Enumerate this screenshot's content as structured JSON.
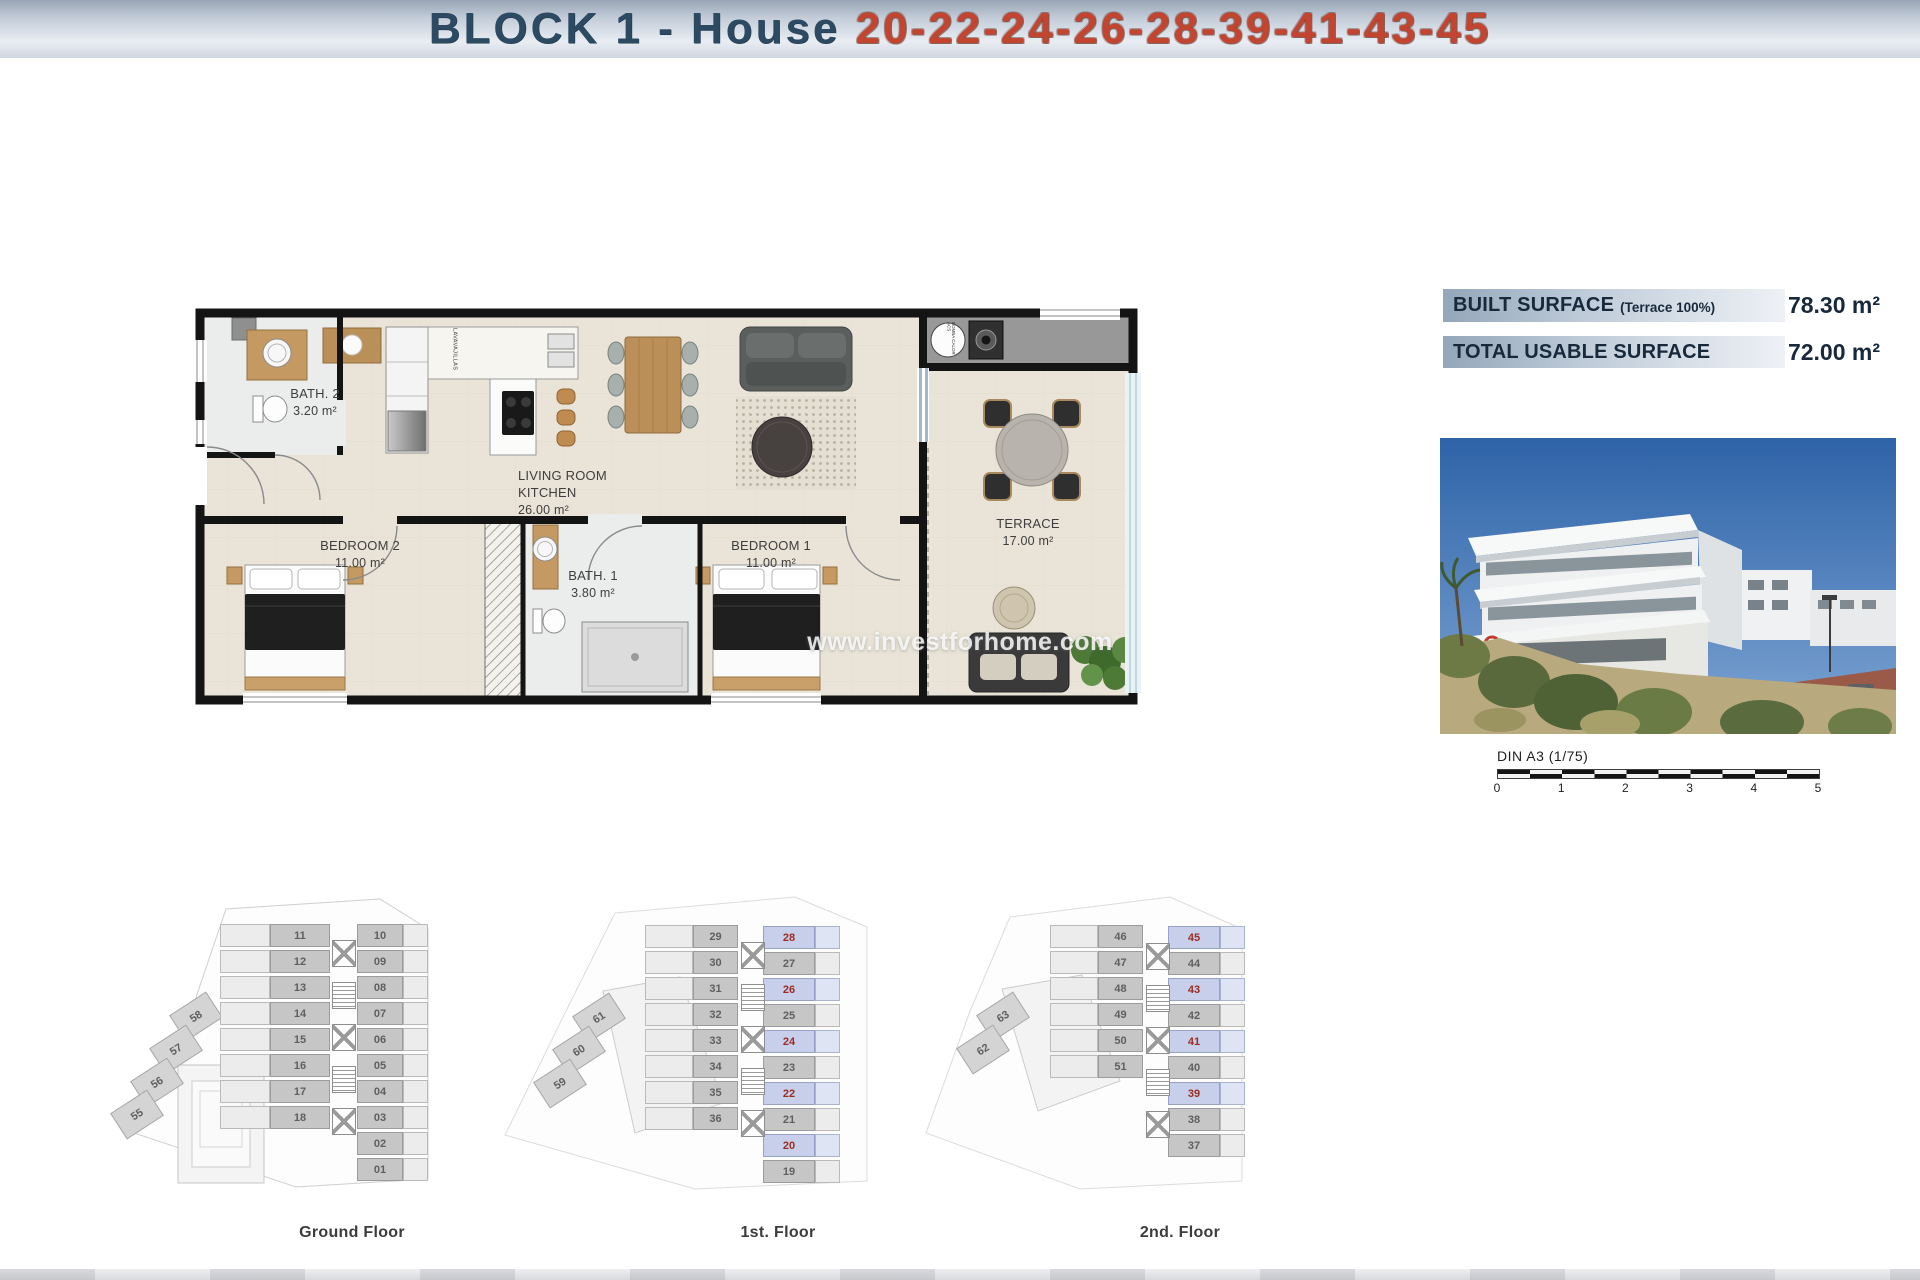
{
  "header": {
    "title_prefix": "BLOCK 1 - House ",
    "title_numbers": "20-22-24-26-28-39-41-43-45",
    "prefix_color": "#2d4a63",
    "numbers_color": "#c4452f"
  },
  "surface_panel": {
    "rows": [
      {
        "label": "BUILT SURFACE",
        "sublabel": "(Terrace 100%)",
        "value": "78.30 m²"
      },
      {
        "label": "TOTAL USABLE SURFACE",
        "sublabel": "",
        "value": "72.00 m²"
      }
    ]
  },
  "floorplan": {
    "rooms": {
      "bath2": {
        "name": "BATH. 2",
        "area": "3.20 m²"
      },
      "living": {
        "name": "LIVING ROOM KITCHEN",
        "area": "26.00 m²"
      },
      "bedroom2": {
        "name": "BEDROOM 2",
        "area": "11.00 m²"
      },
      "bath1": {
        "name": "BATH. 1",
        "area": "3.80 m²"
      },
      "bedroom1": {
        "name": "BEDROOM 1",
        "area": "11.00 m²"
      },
      "terrace": {
        "name": "TERRACE",
        "area": "17.00 m²"
      }
    },
    "annotations": {
      "dishwasher": "LAVAVAJILLAS",
      "heat_pump": "BOMBA CALOR ACS"
    }
  },
  "watermark": "www.investforhome.com",
  "scale_bar": {
    "label": "DIN A3 (1/75)",
    "ticks": [
      "0",
      "1",
      "2",
      "3",
      "4",
      "5"
    ]
  },
  "floors": [
    {
      "label": "Ground Floor",
      "left_units": [
        "11",
        "12",
        "13",
        "14",
        "15",
        "16",
        "17",
        "18"
      ],
      "right_units": [
        "10",
        "09",
        "08",
        "07",
        "06",
        "05",
        "04",
        "03",
        "02",
        "01"
      ],
      "annex_units": [
        "58",
        "57",
        "56",
        "55"
      ],
      "highlighted": []
    },
    {
      "label": "1st. Floor",
      "left_units": [
        "29",
        "30",
        "31",
        "32",
        "33",
        "34",
        "35",
        "36"
      ],
      "right_units": [
        "28",
        "27",
        "26",
        "25",
        "24",
        "23",
        "22",
        "21",
        "20",
        "19"
      ],
      "annex_units": [
        "61",
        "60",
        "59"
      ],
      "highlighted": [
        "28",
        "26",
        "24",
        "22",
        "20"
      ]
    },
    {
      "label": "2nd. Floor",
      "left_units": [
        "46",
        "47",
        "48",
        "49",
        "50",
        "51"
      ],
      "right_units": [
        "45",
        "44",
        "43",
        "42",
        "41",
        "40",
        "39",
        "38",
        "37"
      ],
      "annex_units": [
        "63",
        "62"
      ],
      "highlighted": [
        "45",
        "43",
        "41",
        "39"
      ]
    }
  ],
  "colors": {
    "highlight_bg": "#c7cfeb",
    "highlight_bg_light": "#dfe4f5",
    "highlight_number": "#9e2b20",
    "unit_number": "#5f5f5f"
  }
}
